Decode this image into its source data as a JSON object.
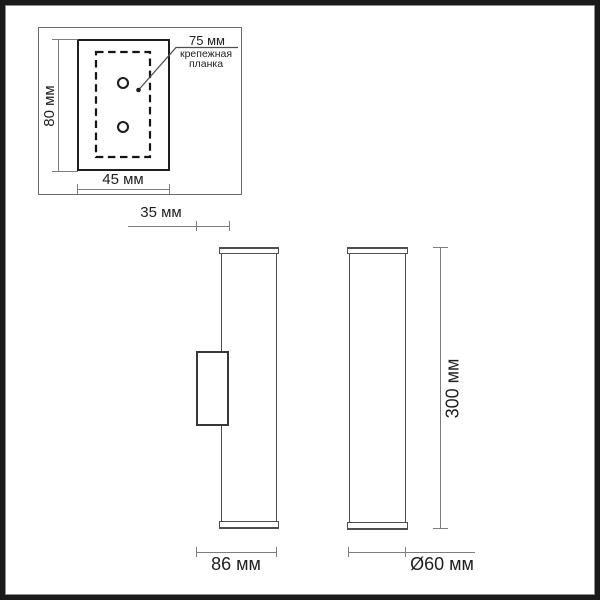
{
  "meta": {
    "bg": "#ffffff",
    "frame": "#1a1a1a",
    "object_line": "#4f4f4f",
    "plate_line": "#1e1e1e",
    "dim_line": "#7d7d7d",
    "text": "#1f1f1f"
  },
  "mount_detail": {
    "dim_75": "75 мм",
    "plate_label_line1": "крепежная",
    "plate_label_line2": "планка",
    "dim_80": "80 мм",
    "dim_45": "45 мм"
  },
  "offsets": {
    "dim_35": "35 мм"
  },
  "side_views": {
    "dim_300": "300 мм",
    "dim_86": "86 мм",
    "dim_60": "Ø60 мм"
  }
}
